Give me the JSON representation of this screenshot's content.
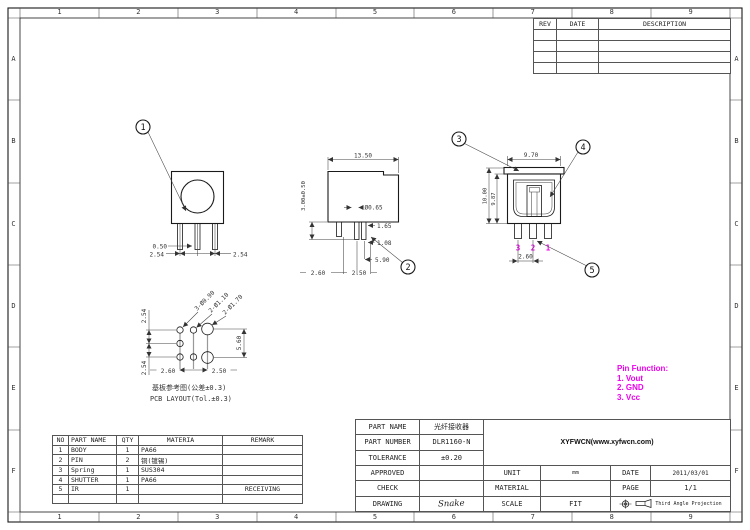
{
  "colors": {
    "magenta": "#ee00ee",
    "line": "#1a1a1a"
  },
  "grid": {
    "cols": [
      "1",
      "2",
      "3",
      "4",
      "5",
      "6",
      "7",
      "8",
      "9"
    ],
    "rows": [
      "A",
      "B",
      "C",
      "D",
      "E",
      "F"
    ]
  },
  "revision_table": {
    "rev": "REV",
    "date": "DATE",
    "description": "DESCRIPTION"
  },
  "parts_table": {
    "headers": [
      "NO",
      "PART NAME",
      "QTY",
      "MATERIA",
      "REMARK"
    ],
    "rows": [
      [
        "1",
        "BODY",
        "1",
        "PA66",
        ""
      ],
      [
        "2",
        "PIN",
        "2",
        "铜(镀锡)",
        ""
      ],
      [
        "3",
        "Spring",
        "1",
        "SUS304",
        ""
      ],
      [
        "4",
        "SHUTTER",
        "1",
        "PA66",
        ""
      ],
      [
        "5",
        "IR",
        "1",
        "",
        "RECEIVING"
      ],
      [
        "",
        "",
        "",
        "",
        ""
      ]
    ]
  },
  "title_block": {
    "part_name_label": "PART NAME",
    "part_name_value": "光纤接收器",
    "part_number_label": "PART NUMBER",
    "part_number_value": "DLR1160-N",
    "tolerance_label": "TOLERANCE",
    "tolerance_value": "±0.20",
    "approved_label": "APPROVED",
    "approved_value": "",
    "check_label": "CHECK",
    "check_value": "",
    "drawing_label": "DRAWING",
    "drawing_value": "Snake",
    "company": "XYFWCN(www.xyfwcn.com)",
    "unit_label": "UNIT",
    "unit_value": "mm",
    "material_label": "MATERIAL",
    "material_value": "",
    "scale_label": "SCALE",
    "scale_value": "FIT",
    "date_label": "DATE",
    "date_value": "2011/03/01",
    "page_label": "PAGE",
    "page_value": "1/1",
    "projection": "Third Angle Projection"
  },
  "pin_function": {
    "title": "Pin Function:",
    "items": [
      "1. Vout",
      "2. GND",
      "3. Vcc"
    ]
  },
  "views": {
    "front": {
      "balloon": "1",
      "dim_pin_width": "0.50",
      "dim_pitch_left": "2.54",
      "dim_pitch_right": "2.54"
    },
    "side": {
      "balloon": "2",
      "dim_width": "13.50",
      "dim_pin_length": "3.00±0.50",
      "dim_pin_dia": "Ø0.65",
      "dim_a": "1.65",
      "dim_b": "1.08",
      "dim_c": "5.90",
      "dim_d": "2.60",
      "dim_e": "2.50"
    },
    "rear": {
      "balloon_top": "3",
      "balloon_right": "4",
      "balloon_bottom": "5",
      "dim_width": "9.70",
      "dim_height_outer": "10.00",
      "dim_height_inner": "9.87",
      "dim_pin_pitch": "2.60",
      "pin_numbers": [
        "3",
        "2",
        "1"
      ]
    },
    "pcb": {
      "hole_small": "3-Ø0.90",
      "hole_mid": "2-Ø1.10",
      "hole_big": "2-Ø1.70",
      "dim_pitch_top": "2.54",
      "dim_pitch_bottom": "2.54",
      "dim_span": "5.60",
      "dim_h1": "2.60",
      "dim_h2": "2.50",
      "caption_cn": "基板参考图(公差±0.3)",
      "caption_en": "PCB LAYOUT(Tol.±0.3)"
    }
  }
}
